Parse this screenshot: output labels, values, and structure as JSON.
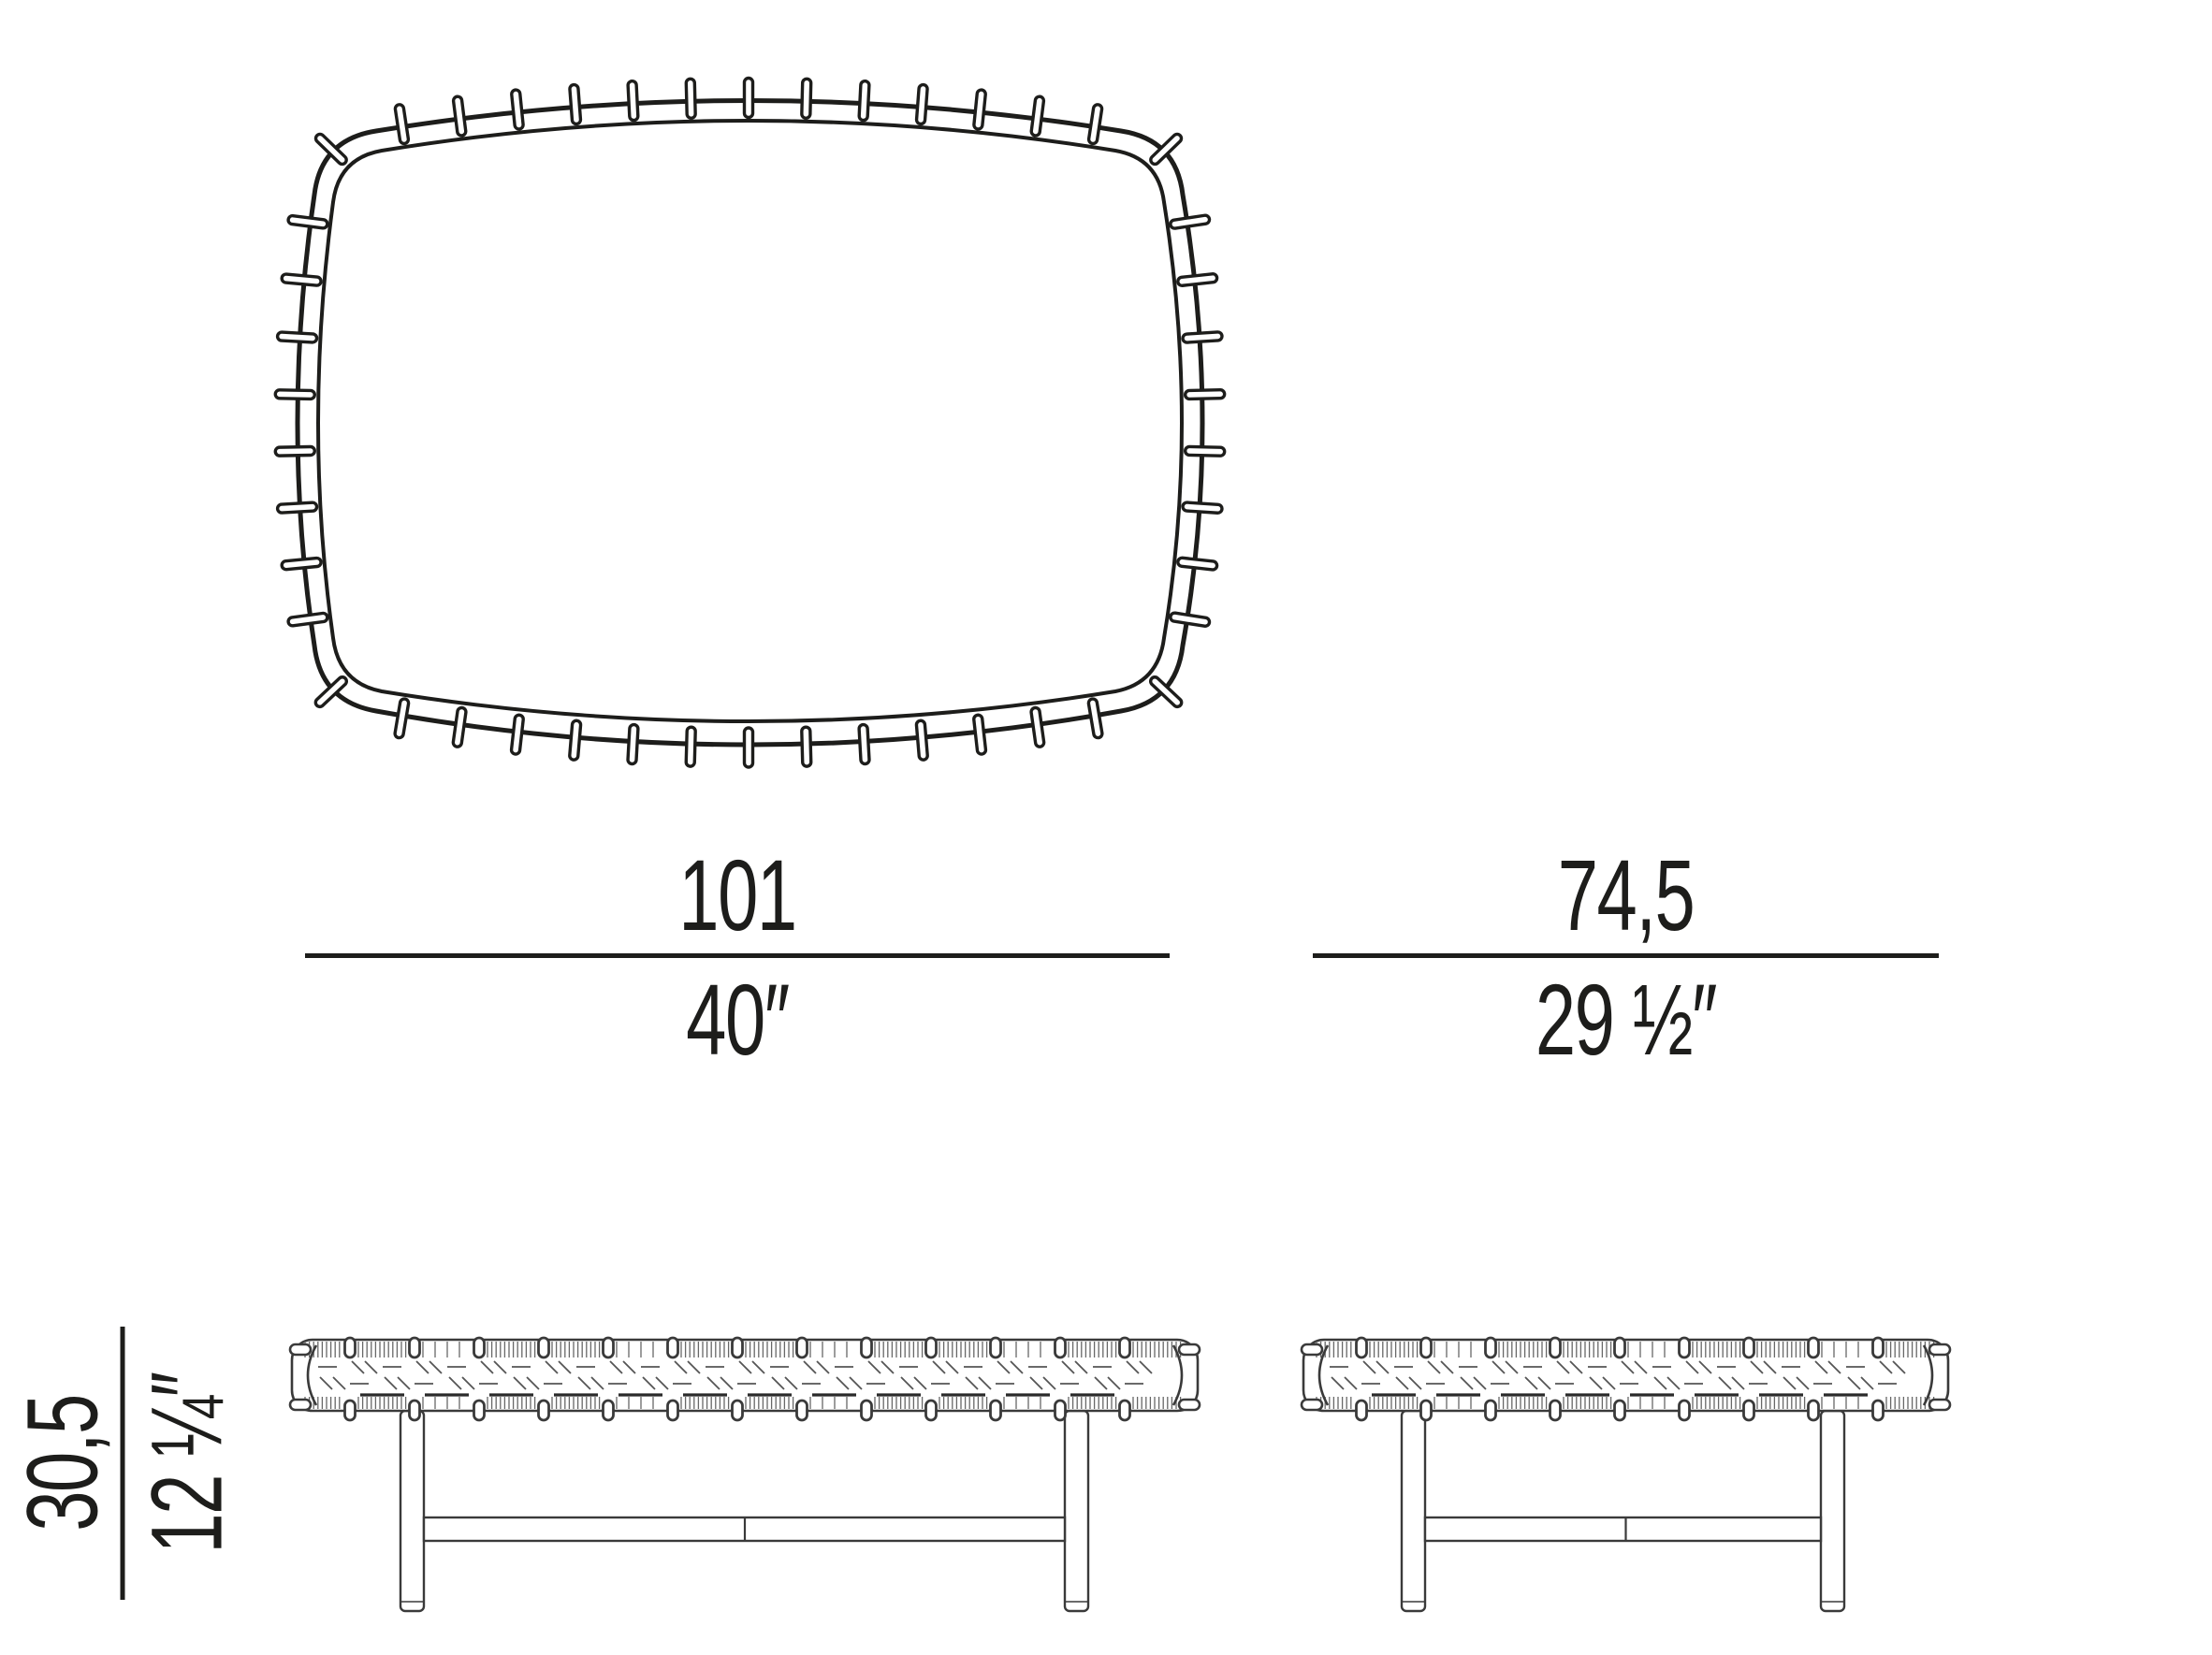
{
  "colors": {
    "ink": "#1d1d1b",
    "draft": "#3a3a3a",
    "hatch": "#686868",
    "background": "#ffffff"
  },
  "dimensions": {
    "width": {
      "metric": "101",
      "imperial": "40″"
    },
    "depth": {
      "metric": "74,5",
      "imperial": "29 ½″"
    },
    "height": {
      "metric": "30,5",
      "imperial": "12 ¼″"
    }
  }
}
